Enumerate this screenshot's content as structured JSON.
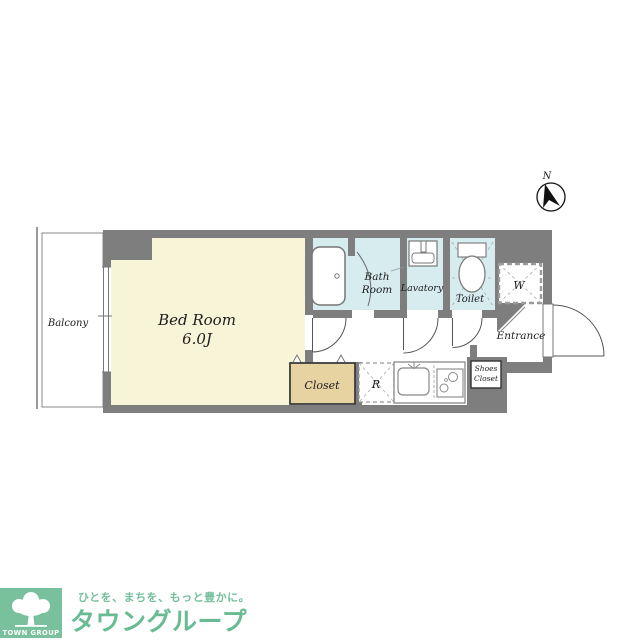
{
  "plan": {
    "rooms": {
      "balcony": {
        "label": "Balcony"
      },
      "bedroom": {
        "label": "Bed Room",
        "size": "6.0J"
      },
      "bathroom": {
        "label_line1": "Bath",
        "label_line2": "Room"
      },
      "lavatory": {
        "label": "Lavatory"
      },
      "toilet": {
        "label": "Toilet"
      },
      "washer_space": {
        "label": "W"
      },
      "entrance": {
        "label": "Entrance"
      },
      "shoes_closet": {
        "label_line1": "Shoes",
        "label_line2": "Closet"
      },
      "closet": {
        "label": "Closet"
      },
      "refrigerator_space": {
        "label": "R"
      }
    },
    "compass": {
      "north_label": "N"
    },
    "colors": {
      "wall_gray": "#7e7e7e",
      "bedroom_cream": "#f8f4d8",
      "wet_area_blue": "#d6ecef",
      "closet_tan": "#e7d2a2"
    }
  },
  "logo": {
    "group_name": "TOWN GROUP",
    "tagline": "ひとを、まちを、もっと豊かに。",
    "brand": "タウングループ",
    "green_box": "#79c09c",
    "text_green": "#68bb92"
  }
}
